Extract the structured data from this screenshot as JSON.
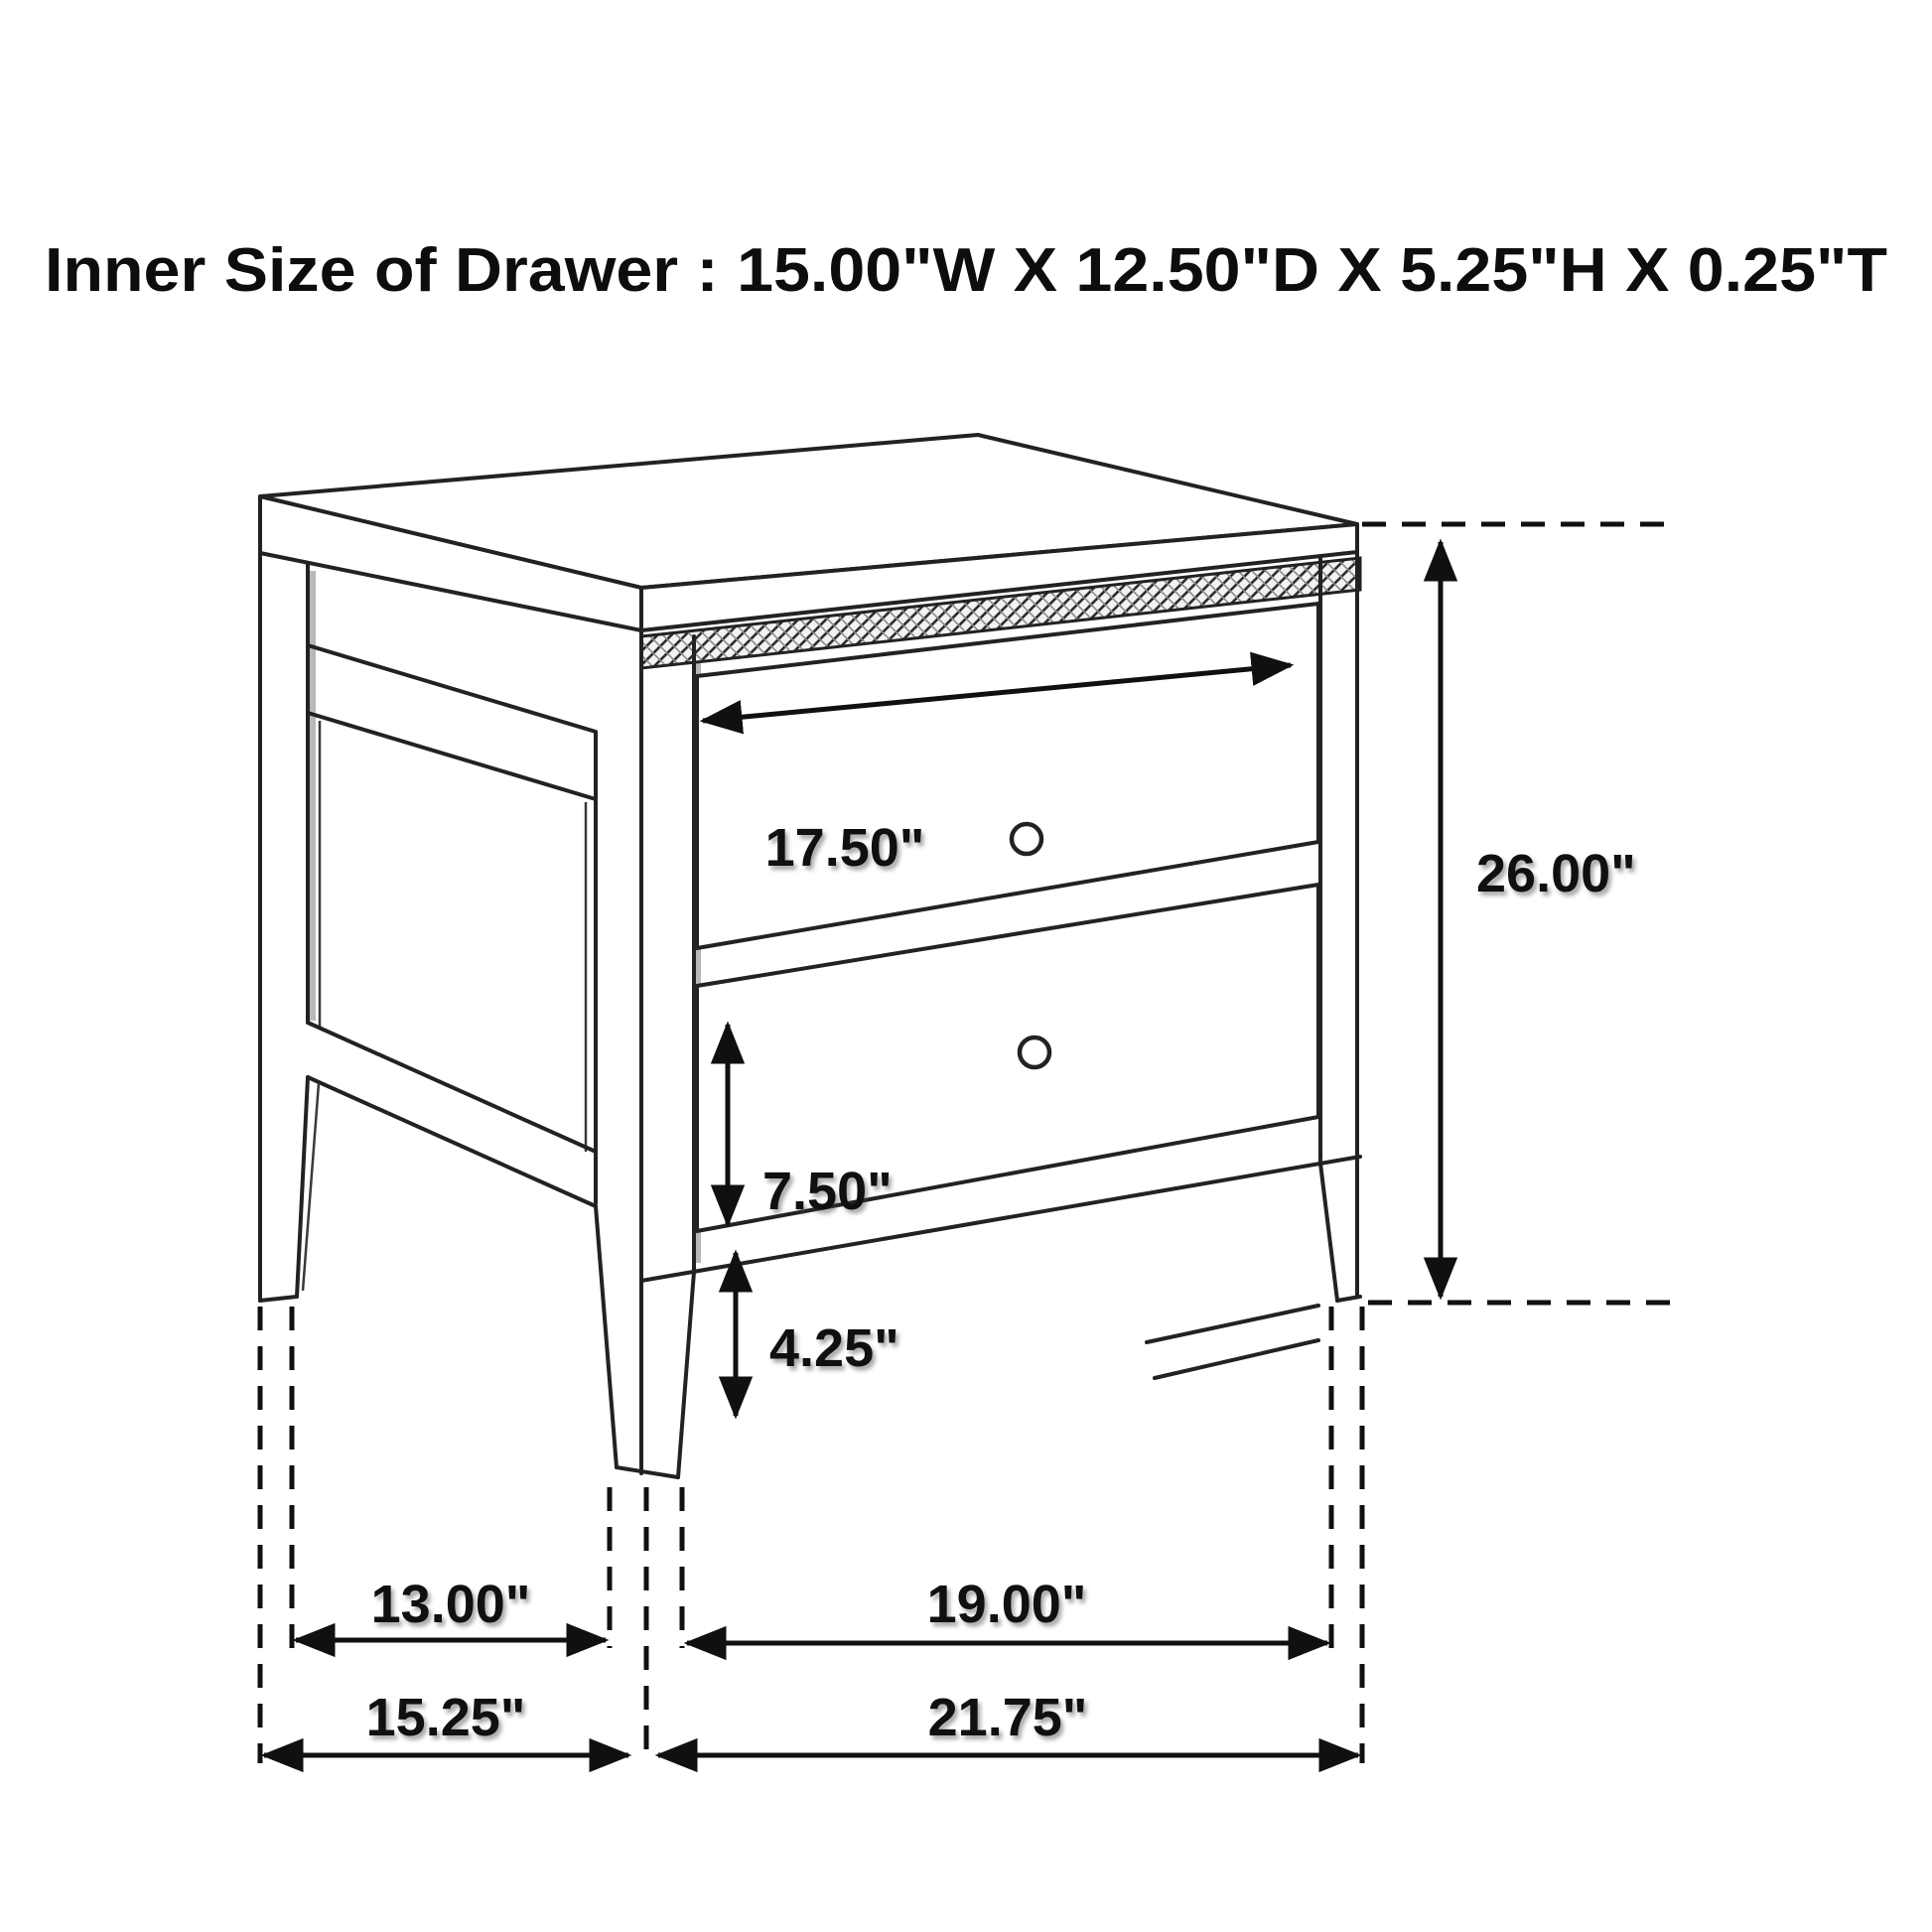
{
  "title": "Inner Size of Drawer : 15.00\"W X 12.50\"D X 5.25\"H X 0.25\"T",
  "inner_drawer_size": {
    "width": "15.00\"W",
    "depth": "12.50\"D",
    "height": "5.25\"H",
    "thickness": "0.25\"T"
  },
  "labels": {
    "drawer_front_width": "17.50\"",
    "overall_height": "26.00\"",
    "bottom_drawer_height": "7.50\"",
    "leg_height": "4.25\"",
    "depth_between_legs": "13.00\"",
    "width_between_legs": "19.00\"",
    "overall_depth": "15.25\"",
    "overall_width": "21.75\""
  },
  "colors": {
    "background": "#ffffff",
    "line": "#222222",
    "dimension": "#101010"
  }
}
